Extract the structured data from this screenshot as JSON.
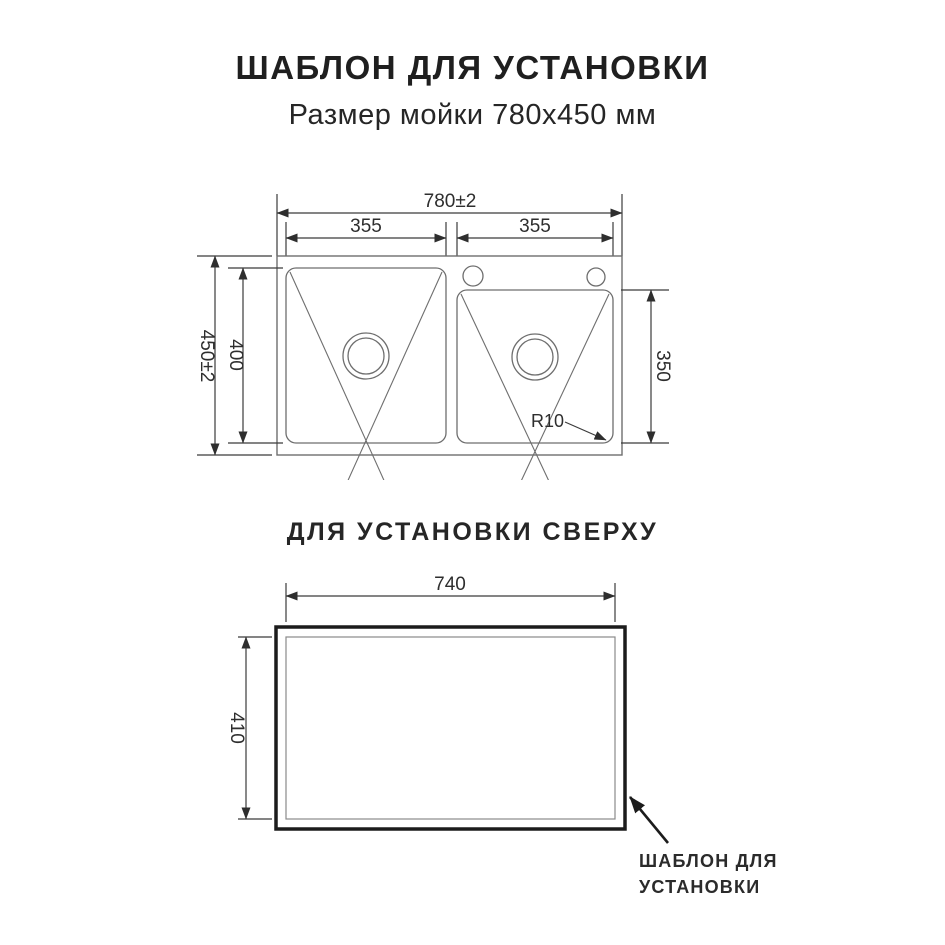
{
  "header": {
    "title": "ШАБЛОН ДЛЯ УСТАНОВКИ",
    "subtitle": "Размер мойки 780х450 мм"
  },
  "section2": {
    "title": "ДЛЯ УСТАНОВКИ СВЕРХУ"
  },
  "sink_drawing": {
    "overall_width": "780±2",
    "overall_height": "450±2",
    "left_bowl_width": "355",
    "right_bowl_width": "355",
    "left_bowl_height": "400",
    "right_bowl_height": "350",
    "corner_radius": "R10"
  },
  "cutout_drawing": {
    "cutout_width": "740",
    "cutout_height": "410",
    "callout_line1": "ШАБЛОН ДЛЯ",
    "callout_line2": "УСТАНОВКИ"
  },
  "colors": {
    "geometry_line": "#6e6e6e",
    "dimension_line": "#3b3b3b",
    "outline_black": "#1c1c1c",
    "background": "#ffffff"
  }
}
